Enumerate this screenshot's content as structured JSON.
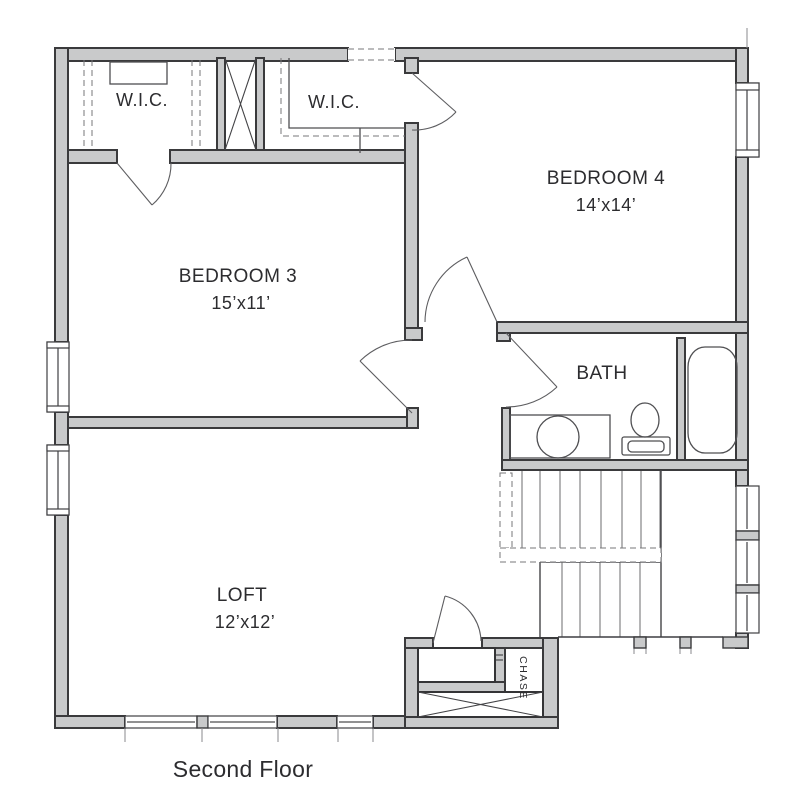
{
  "title": {
    "caption": "Second Floor"
  },
  "rooms": {
    "wic1": {
      "label": "W.I.C."
    },
    "wic2": {
      "label": "W.I.C."
    },
    "bedroom4": {
      "name": "BEDROOM 4",
      "dims": "14’x14’"
    },
    "bedroom3": {
      "name": "BEDROOM 3",
      "dims": "15’x11’"
    },
    "bath": {
      "label": "BATH"
    },
    "loft": {
      "name": "LOFT",
      "dims": "12’x12’"
    },
    "chase": {
      "label": "CHASE"
    }
  },
  "colors": {
    "wall_fill": "#c9cacb",
    "wall_line": "#3a3a3c",
    "thin_line": "#4f4f52",
    "text": "#2c2c2f",
    "background": "#ffffff"
  }
}
